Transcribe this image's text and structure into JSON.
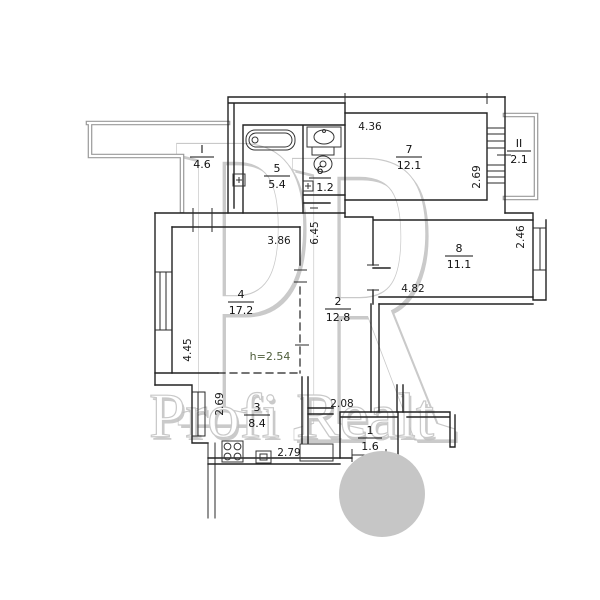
{
  "watermark": {
    "monogram": "PR",
    "brand": "Profi Realt",
    "circle_color": "#c6c6c6"
  },
  "plan": {
    "height_note": "h=2.54",
    "rooms": [
      {
        "number": "1",
        "area": "1.6"
      },
      {
        "number": "2",
        "area": "12.8"
      },
      {
        "number": "3",
        "area": "8.4"
      },
      {
        "number": "4",
        "area": "17.2"
      },
      {
        "number": "5",
        "area": "5.4"
      },
      {
        "number": "6",
        "area": "1.2"
      },
      {
        "number": "7",
        "area": "12.1"
      },
      {
        "number": "8",
        "area": "11.1"
      },
      {
        "number": "I",
        "area": "4.6"
      },
      {
        "number": "II",
        "area": "2.1"
      }
    ],
    "dimensions": [
      {
        "value": "4.36"
      },
      {
        "value": "2.69"
      },
      {
        "value": "2.46"
      },
      {
        "value": "4.82"
      },
      {
        "value": "3.86"
      },
      {
        "value": "6.45"
      },
      {
        "value": "4.45"
      },
      {
        "value": "2.69"
      },
      {
        "value": "2.08"
      },
      {
        "value": "2.79"
      }
    ]
  }
}
